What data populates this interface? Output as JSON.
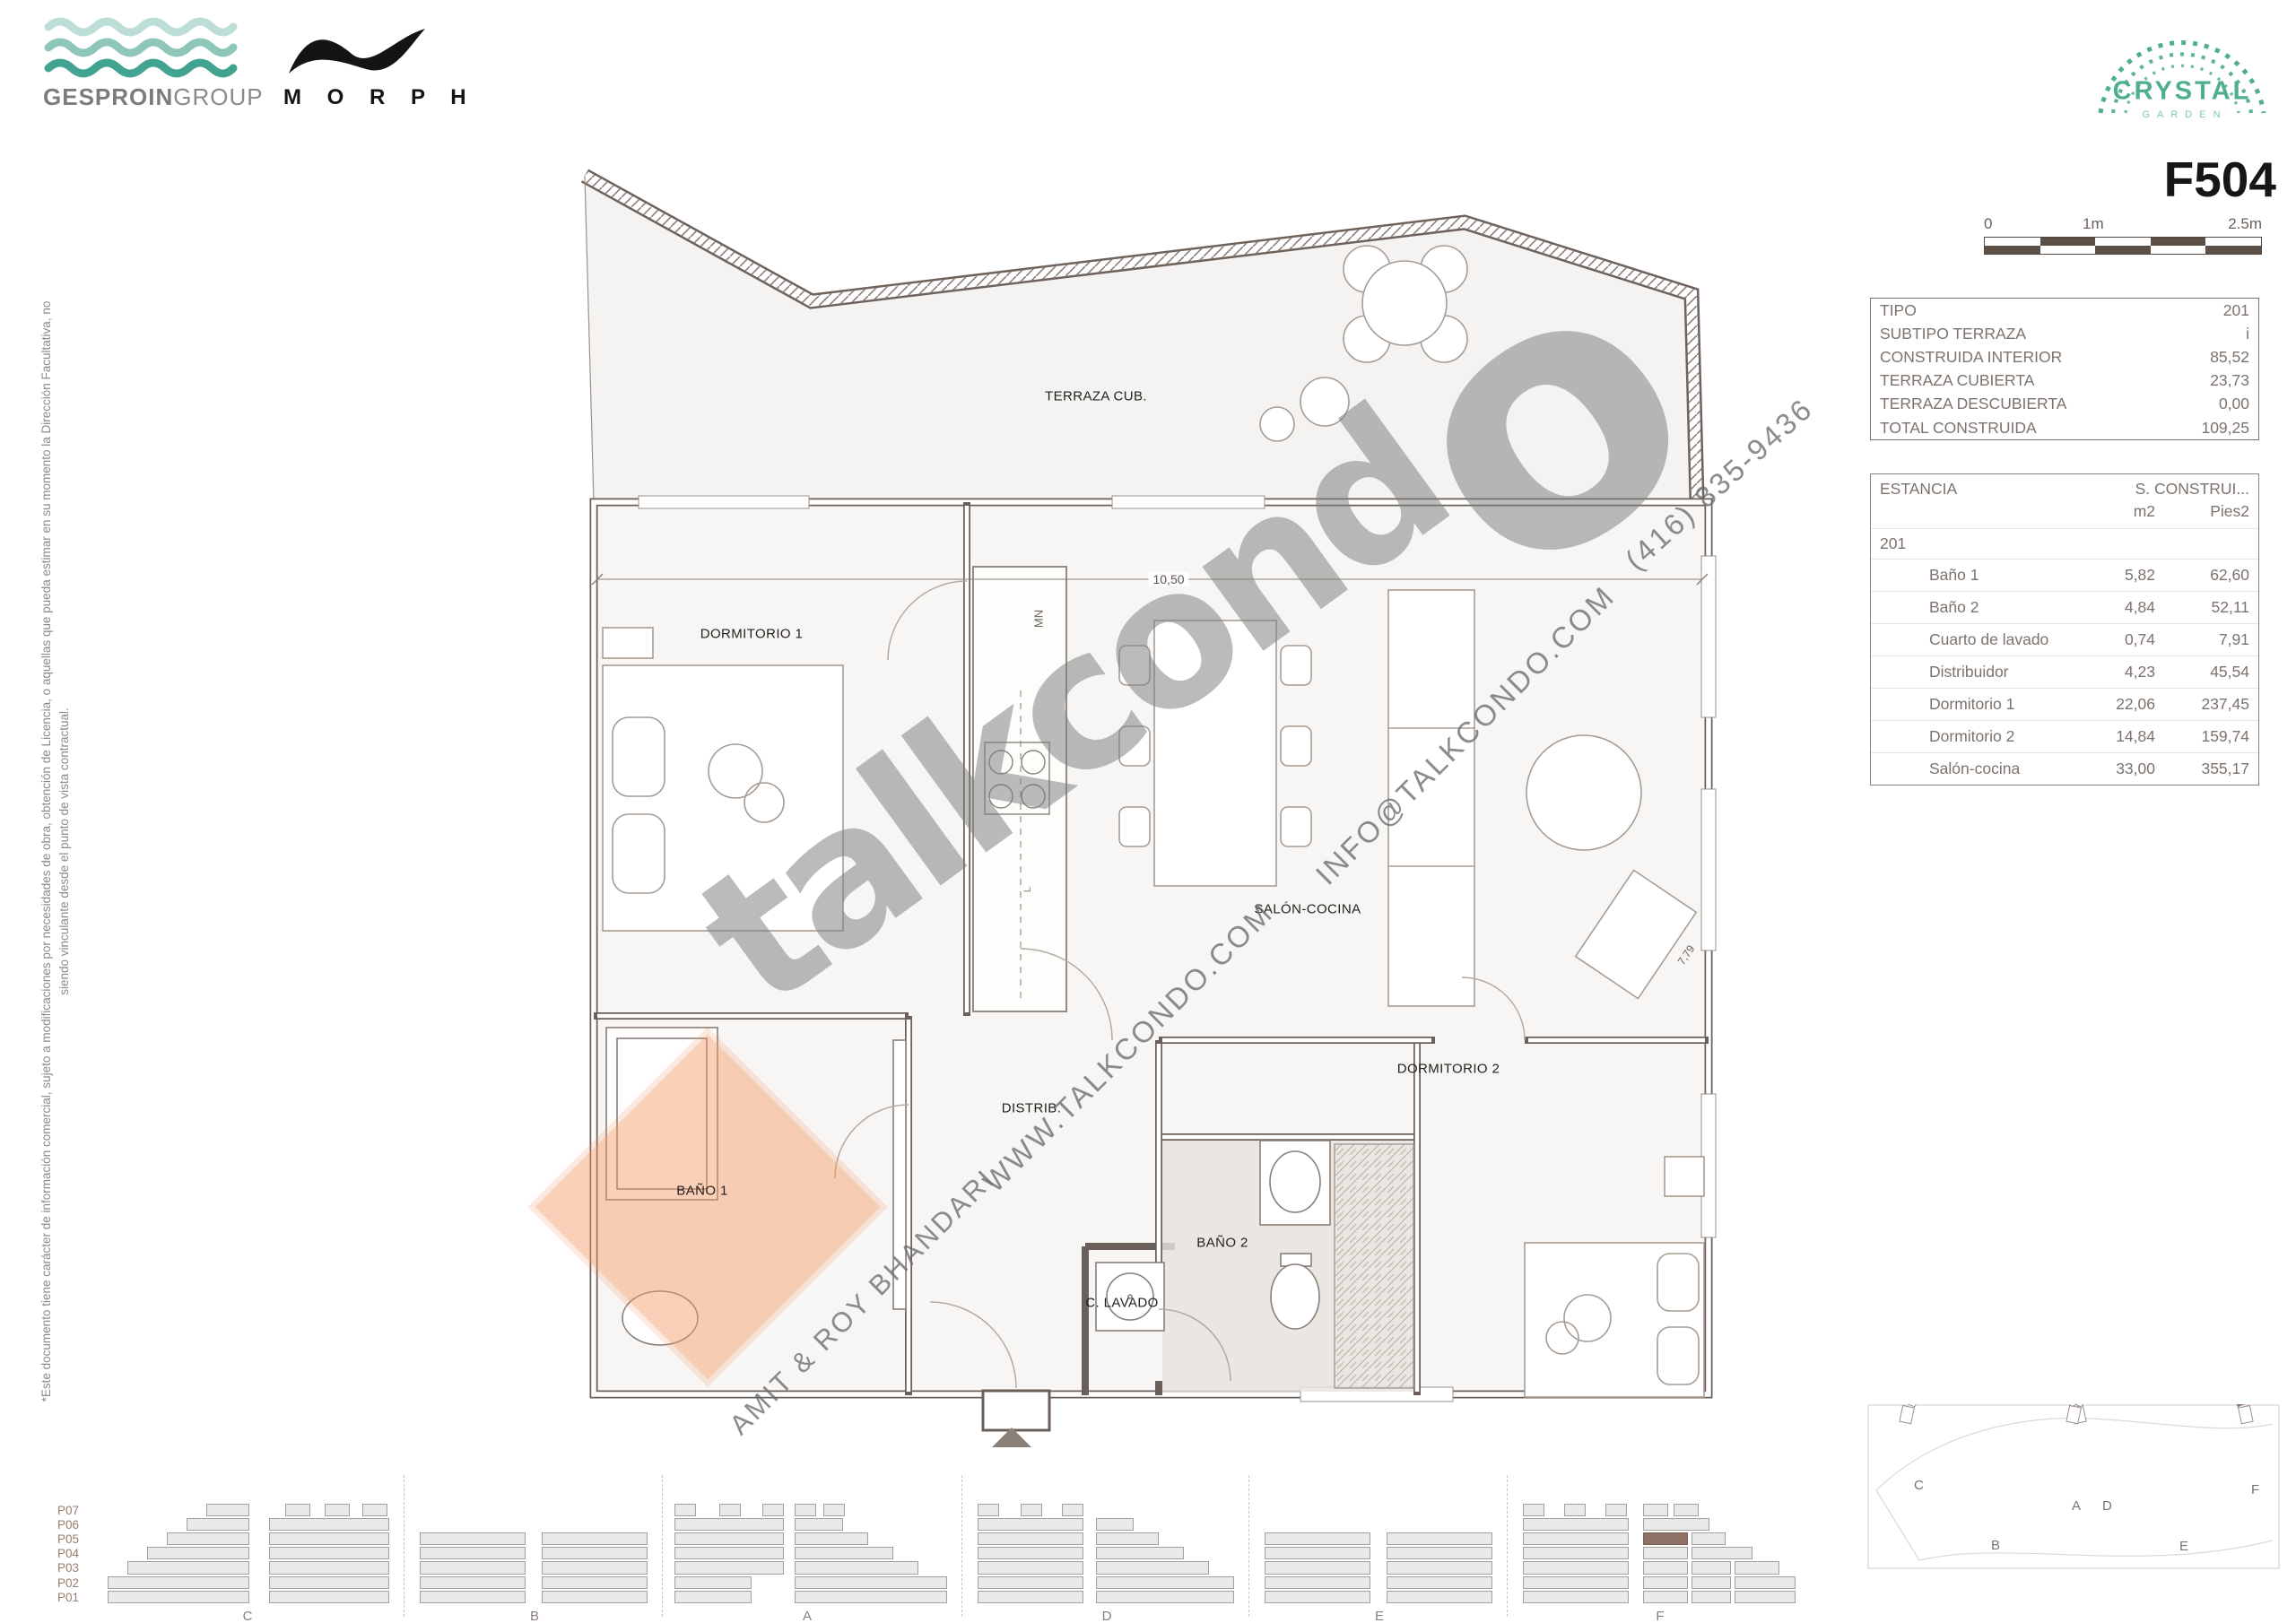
{
  "branding": {
    "gesproin_bold": "GESPROIN",
    "gesproin_light": "GROUP",
    "morph": "M O R P H",
    "crystal": "CRYSTAL",
    "crystal_sub": "GARDEN"
  },
  "unit_code": "F504",
  "scalebar": {
    "t0": "0",
    "t1": "1m",
    "t2": "2.5m",
    "dark": "#5c4f46"
  },
  "info_table": {
    "rows": [
      [
        "TIPO",
        "201"
      ],
      [
        "SUBTIPO TERRAZA",
        "i"
      ],
      [
        "CONSTRUIDA INTERIOR",
        "85,52"
      ],
      [
        "TERRAZA CUBIERTA",
        "23,73"
      ],
      [
        "TERRAZA DESCUBIERTA",
        "0,00"
      ],
      [
        "TOTAL CONSTRUIDA",
        "109,25"
      ]
    ]
  },
  "estancia_table": {
    "col_estancia": "ESTANCIA",
    "col_construida": "S. CONSTRUI...",
    "unit_m2": "m2",
    "unit_pies2": "Pies2",
    "group": "201",
    "rows": [
      [
        "Baño 1",
        "5,82",
        "62,60"
      ],
      [
        "Baño 2",
        "4,84",
        "52,11"
      ],
      [
        "Cuarto de lavado",
        "0,74",
        "7,91"
      ],
      [
        "Distribuidor",
        "4,23",
        "45,54"
      ],
      [
        "Dormitorio 1",
        "22,06",
        "237,45"
      ],
      [
        "Dormitorio 2",
        "14,84",
        "159,74"
      ],
      [
        "Salón-cocina",
        "33,00",
        "355,17"
      ]
    ]
  },
  "disclaimer": {
    "line1": "*Este documento tiene carácter de información comercial, sujeto a modificaciones por necesidades de obra, obtención de Licencia, o aquellas que pueda estimar en su momento la Dirección Facultativa, no",
    "line2": "siendo vinculante desde el punto de vista contractual."
  },
  "plan": {
    "labels": {
      "terraza": "TERRAZA CUB.",
      "dorm1": "DORMITORIO 1",
      "salon": "SALÓN-COCINA",
      "distrib": "DISTRIB.",
      "bano1": "BAÑO 1",
      "bano2": "BAÑO 2",
      "lavado": "C. LAVADO",
      "dorm2": "DORMITORIO 2"
    },
    "dims": {
      "width": "10,50",
      "diag": "7,79",
      "mn": "MN",
      "l": "L"
    }
  },
  "watermark": {
    "brand_head": "talkcond",
    "brand_tail": "o",
    "website": "WWW.TALKCONDO.COM",
    "email": "INFO@TALKCONDO.COM",
    "phone": "(416) 835-9436",
    "agents": "AMIT & ROY BHANDARI"
  },
  "strip": {
    "floors": [
      "P07",
      "P06",
      "P05",
      "P04",
      "P03",
      "P02",
      "P01"
    ],
    "labels": [
      "C",
      "B",
      "A",
      "D",
      "E",
      "F"
    ]
  },
  "site": {
    "labels": [
      "C",
      "B",
      "A",
      "D",
      "E",
      "F"
    ]
  },
  "colors": {
    "wave_light": "#bcded7",
    "wave_mid": "#8ec7ba",
    "wave_dark": "#41a390",
    "crystal_green": "#4fae8e",
    "highlight_orange": "#f29862",
    "block_highlight": "#8f7168"
  }
}
